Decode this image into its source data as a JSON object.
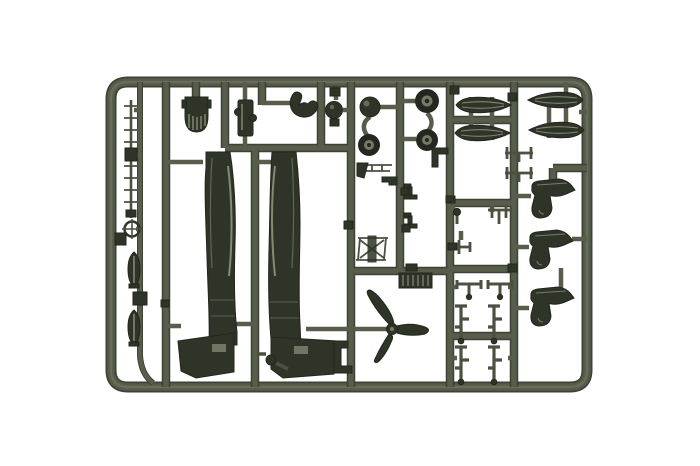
{
  "scene": {
    "type": "photograph",
    "description": "Olive drab injection-moulded plastic model kit sprue (runner frame) with aircraft parts, photographed on a white background",
    "background": "#ffffff"
  },
  "colors": {
    "background": "#ffffff",
    "runner": "#575c4b",
    "runner_edge": "#3e4235",
    "runner_hi": "#797e6b",
    "part": "#2f3428",
    "part_edge": "#22261c",
    "part_mid": "#4b5040",
    "highlight": "#949a81",
    "tire": "#24271f",
    "hub": "#747a66"
  },
  "parts": [
    {
      "id": "sprue-frame",
      "label": "rounded rectangular runner frame"
    },
    {
      "id": "ladder-rack",
      "label": "thin ladder / rack strip"
    },
    {
      "id": "ring-sight",
      "label": "ring sight with cross"
    },
    {
      "id": "bomb-1",
      "label": "bomb"
    },
    {
      "id": "bomb-2",
      "label": "bomb"
    },
    {
      "id": "radiator-bath",
      "label": "radiator bath with grille"
    },
    {
      "id": "engine-block",
      "label": "engine / cockpit part"
    },
    {
      "id": "exhaust-claw",
      "label": "curved intake part"
    },
    {
      "id": "round-knob",
      "label": "round hub part"
    },
    {
      "id": "fuselage-left",
      "label": "fuselage half with wing root"
    },
    {
      "id": "fuselage-right",
      "label": "fuselage half with wing root"
    },
    {
      "id": "tailwheel",
      "label": "tail wheel strut"
    },
    {
      "id": "spinner-ball",
      "label": "propeller spinner"
    },
    {
      "id": "wheel-small",
      "label": "wheel"
    },
    {
      "id": "wheel-top",
      "label": "main wheel"
    },
    {
      "id": "wheel-bottom",
      "label": "main wheel"
    },
    {
      "id": "spat-pair-1",
      "label": "wheel spat half pair"
    },
    {
      "id": "spat-pair-2",
      "label": "wheel spat half pair"
    },
    {
      "id": "wheel-fairing-1",
      "label": "wheel fairing boot"
    },
    {
      "id": "wheel-fairing-2",
      "label": "wheel fairing boot"
    },
    {
      "id": "wheel-fairing-3",
      "label": "wheel fairing boot"
    },
    {
      "id": "propeller",
      "label": "three-blade propeller"
    },
    {
      "id": "radiator-grille",
      "label": "ribbed radiator grille"
    },
    {
      "id": "strut-grid",
      "label": "undercarriage strut set"
    },
    {
      "id": "detail-brackets",
      "label": "small detail brackets"
    }
  ]
}
